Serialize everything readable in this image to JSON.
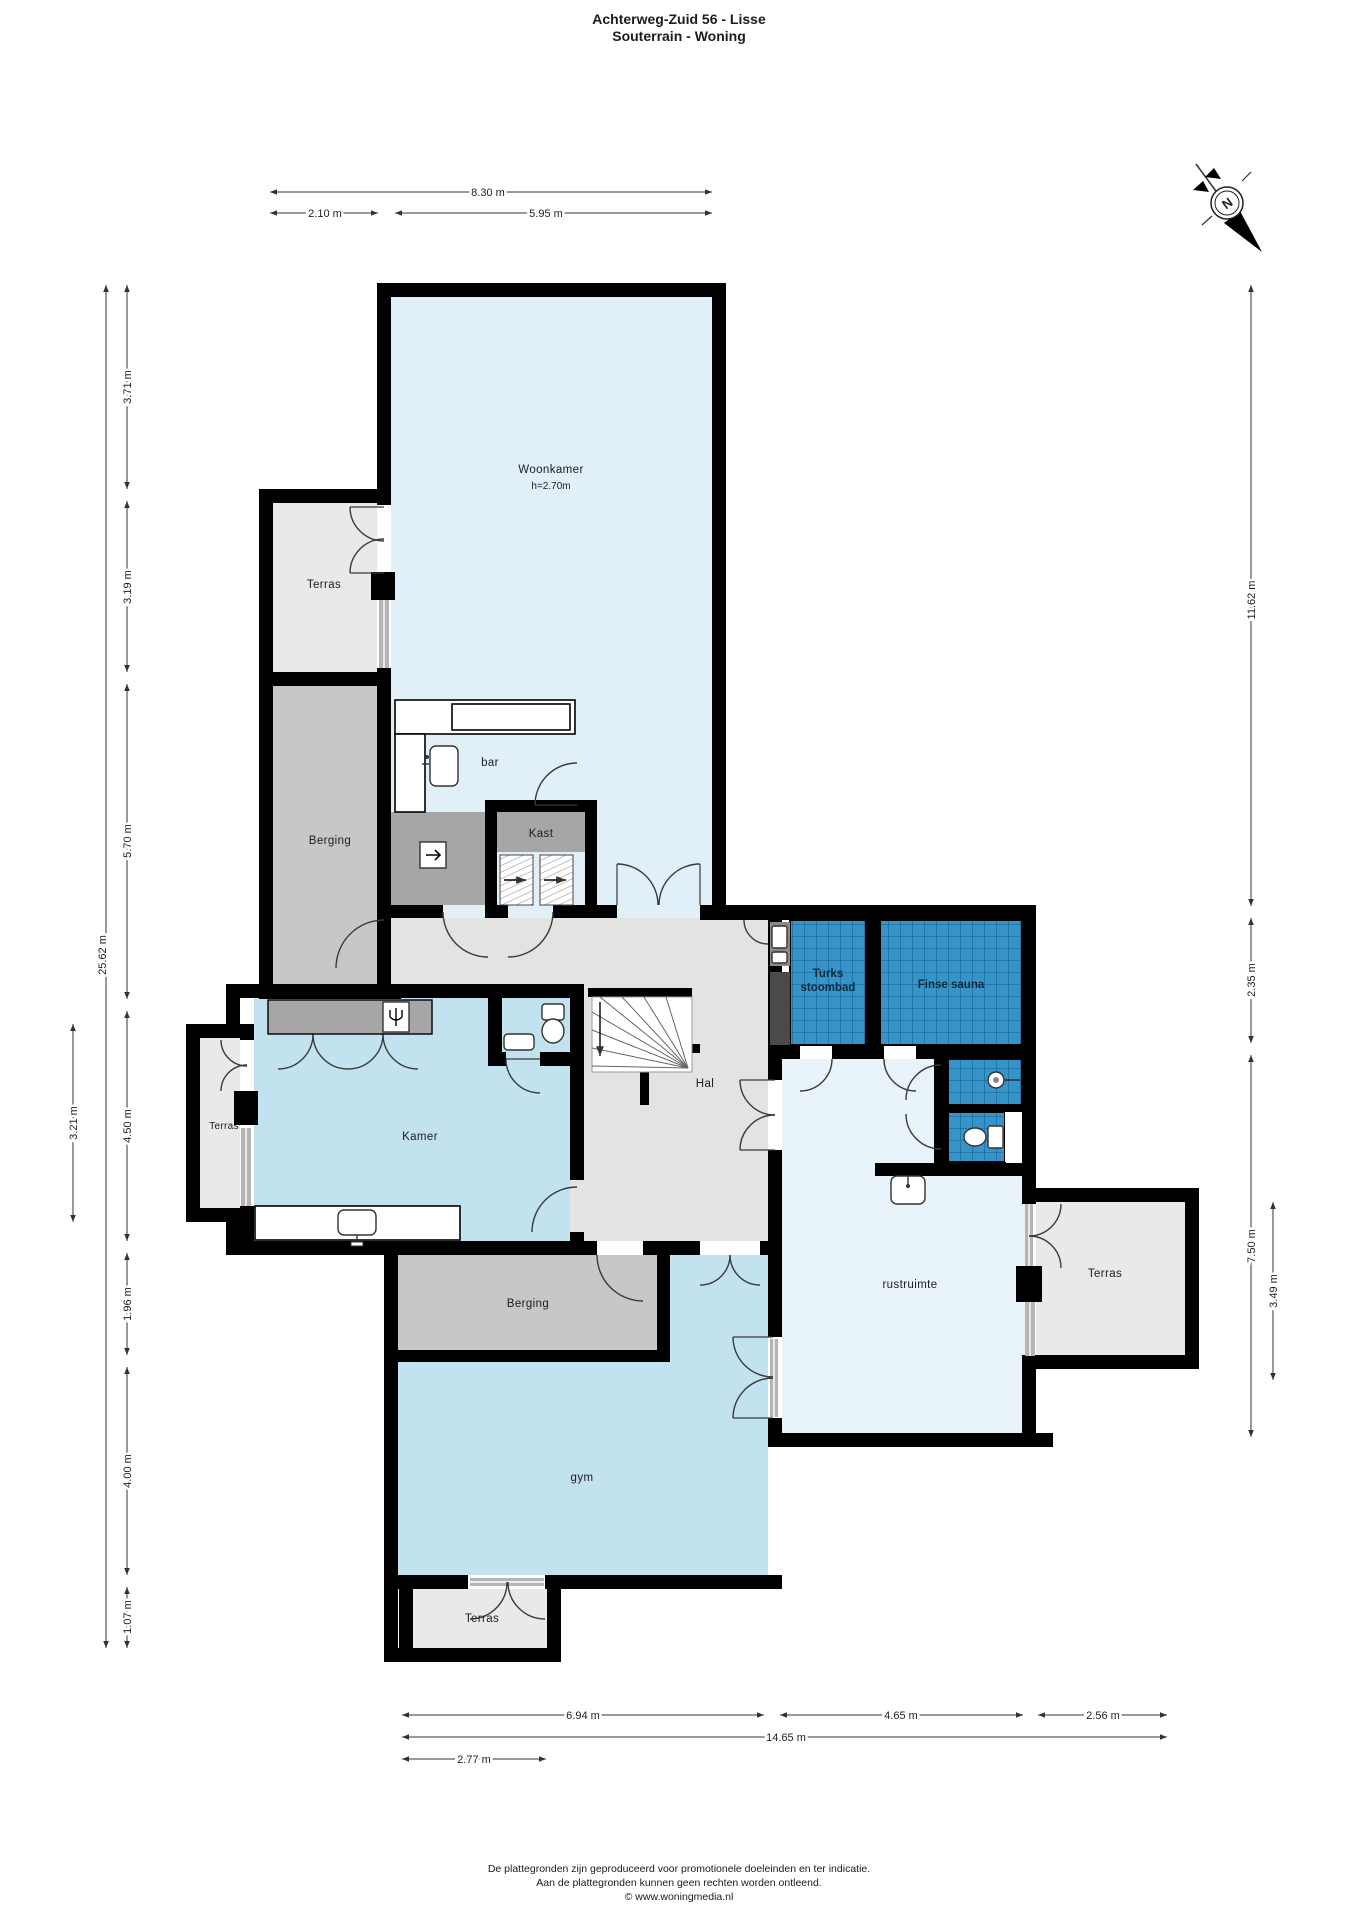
{
  "title": {
    "line1": "Achterweg-Zuid 56 - Lisse",
    "line2": "Souterrain - Woning"
  },
  "compass": {
    "label": "N"
  },
  "rooms": {
    "woonkamer": {
      "label": "Woonkamer",
      "height_note": "h=2.70m"
    },
    "terras_top": {
      "label": "Terras"
    },
    "berging_top": {
      "label": "Berging"
    },
    "bar": {
      "label": "bar"
    },
    "kast": {
      "label": "Kast"
    },
    "turks_stoombad": {
      "label_line1": "Turks",
      "label_line2": "stoombad"
    },
    "finse_sauna": {
      "label": "Finse sauna"
    },
    "hal": {
      "label": "Hal"
    },
    "kamer": {
      "label": "Kamer"
    },
    "terras_left": {
      "label": "Terras"
    },
    "rustruimte": {
      "label": "rustruimte"
    },
    "terras_right": {
      "label": "Terras"
    },
    "berging_mid": {
      "label": "Berging"
    },
    "gym": {
      "label": "gym"
    },
    "terras_bottom": {
      "label": "Terras"
    }
  },
  "dimensions": {
    "top": [
      {
        "label": "8.30 m"
      },
      {
        "label": "2.10 m"
      },
      {
        "label": "5.95 m"
      }
    ],
    "left": [
      {
        "label": "25.62 m"
      },
      {
        "label": "3.71 m"
      },
      {
        "label": "3.19 m"
      },
      {
        "label": "5.70 m"
      },
      {
        "label": "4.50 m"
      },
      {
        "label": "1.96 m"
      },
      {
        "label": "4.00 m"
      },
      {
        "label": "1.07 m"
      },
      {
        "label": "3.21 m"
      }
    ],
    "right": [
      {
        "label": "11.62 m"
      },
      {
        "label": "2.35 m"
      },
      {
        "label": "7.50 m"
      },
      {
        "label": "3.49 m"
      }
    ],
    "bottom": [
      {
        "label": "6.94 m"
      },
      {
        "label": "4.65 m"
      },
      {
        "label": "2.56 m"
      },
      {
        "label": "14.65 m"
      },
      {
        "label": "2.77 m"
      }
    ]
  },
  "footer": {
    "line1": "De plattegronden zijn geproduceerd voor promotionele doeleinden en ter indicatie.",
    "line2": "Aan de plattegronden kunnen geen rechten worden ontleend.",
    "line3": "© www.woningmedia.nl"
  },
  "colors": {
    "wall": "#000000",
    "room-blue": "#e1eff8",
    "room-mid": "#c3e2f0",
    "room-pale": "#e8f4fa",
    "terras": "#e9e9e9",
    "berging": "#c7c7c7",
    "cabinet": "#a6a6a6",
    "hall": "#e3e3e1",
    "tile": "#3794c8",
    "tile-line": "#1a6fa0"
  }
}
